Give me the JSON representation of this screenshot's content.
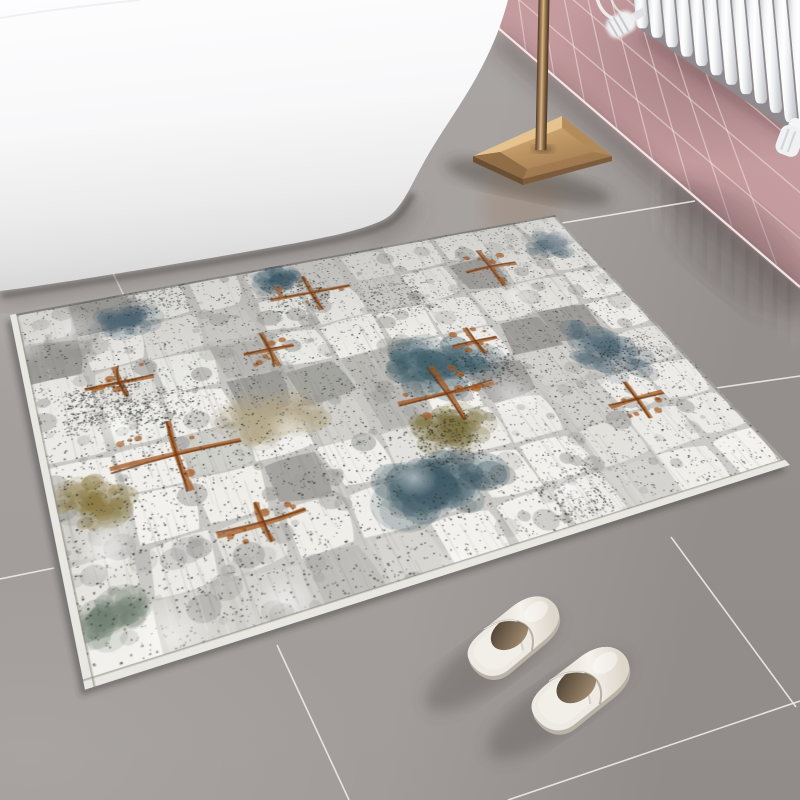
{
  "scene": {
    "title": "Bathroom scene: white freestanding bathtub, pink tiled wall, white column radiator, brass lamp base, abstract distressed grey-teal-rust rug and white slippers on glossy grey tile floor",
    "floor": {
      "base_color": "#a5a09e",
      "grout_color": "rgba(238,235,232,0.9)",
      "grout_segments": [
        [
          112,
          271,
          125,
          298
        ],
        [
          277,
          645,
          349,
          800
        ],
        [
          0,
          579,
          54,
          568
        ],
        [
          695,
          201,
          562,
          223
        ],
        [
          716,
          388,
          800,
          376
        ],
        [
          508,
          800,
          800,
          701
        ],
        [
          671,
          537,
          796,
          707
        ]
      ]
    },
    "wall": {
      "junction": [
        497,
        27,
        800,
        287
      ],
      "junction_color": "#f2eeec",
      "grout_color": "rgba(247,236,236,0.5)",
      "course_spacing": 46,
      "course_slope": 0.85,
      "joint_base_spacing": 26,
      "joint_spacing_growth": 0.08,
      "joint_lean_base": 0.12,
      "joint_lean_growth": 0.0009,
      "shadow_color": "rgba(75,55,55,0.32)"
    },
    "radiator": {
      "x0": 633,
      "bar_width": 12.3,
      "bar_pitch": 14.0,
      "count": 13,
      "lean": 0.09,
      "bottom_x": 637,
      "bottom_y": 26,
      "bottom_slope": 0.67,
      "backdrop_color": "#8e8a8e",
      "bar_stops": [
        "#c7c8cb",
        "#f5f6f7",
        "#ffffff",
        "#edeef0",
        "#bcbdc1"
      ],
      "valve_color": "#f0f1f3",
      "pipe_color": "#edeceb",
      "wall_shadow": "rgba(90,60,62,0.35)"
    },
    "bathtub": {
      "path": "M 0 0 L 508 0 C 501 26 493 47 476 78 C 458 110 440 133 423 164 C 409 189 401 211 383 220 C 358 232 318 239 268 248 C 178 264 78 280 30 287 C 17 289 7 290 0 291 Z",
      "shadow_path": "M 0 294 C 80 282 180 266 270 250 C 320 241 360 234 386 222 C 398 216 405 204 412 192",
      "gradient": [
        "#fdfdfe",
        "#f8f8f9",
        "#ececed",
        "#e2e1e2",
        "#d6d5d5"
      ],
      "contact_shadow": "rgba(58,54,51,0.6)",
      "soft_shadow": "rgba(90,85,82,0.35)",
      "seam_color": "rgba(0,0,0,0.05)"
    },
    "lamp": {
      "pole": {
        "x": 538.5,
        "top": -4,
        "bottom": 150,
        "w": 11,
        "stops": [
          "#4f3b28",
          "#a5825c",
          "#d9b586",
          "#8a6b48",
          "#46331f"
        ]
      },
      "base": {
        "L": [
          473,
          156
        ],
        "T": [
          562,
          116
        ],
        "R": [
          612,
          156
        ],
        "B": [
          523,
          179
        ],
        "inner": [
          [
            500,
            152
          ],
          [
            562,
            128
          ],
          [
            594,
            152
          ],
          [
            527,
            169
          ]
        ],
        "top_hi": "#e7c793",
        "top_mid": "#c39a68",
        "top_lo": "#9c7850",
        "bevel_left": "#8a6742",
        "bevel_right": "#b08a58",
        "side_dark": "#6b4f35",
        "side_mid": "#7d5c3d"
      },
      "shadow": "rgba(66,56,46,0.40)",
      "reflection": "rgba(150,115,75,0.22)"
    },
    "rug": {
      "quad": [
        [
          10,
          315
        ],
        [
          555,
          215
        ],
        [
          790,
          465
        ],
        [
          85,
          690
        ]
      ],
      "tex_w": 760,
      "tex_h": 520,
      "base": "#c8c7c3",
      "block_cols": 11,
      "block_rows": 8,
      "block_colors": [
        "#f2f1ed",
        "#e6e5e0",
        "#d2d1cc",
        "#b6b5b1",
        "#9c9b97"
      ],
      "speckle_dark": "#2c2c28",
      "speckle_mid": "#5a5a54",
      "features": [
        {
          "x": 0.6,
          "y": 0.47,
          "rx": 0.085,
          "ry": 0.085,
          "c": "#43616d"
        },
        {
          "x": 0.5,
          "y": 0.8,
          "rx": 0.09,
          "ry": 0.065,
          "c": "#3e5a66"
        },
        {
          "x": 0.17,
          "y": 0.1,
          "rx": 0.05,
          "ry": 0.05,
          "c": "#4a6676"
        },
        {
          "x": 0.88,
          "y": 0.54,
          "rx": 0.06,
          "ry": 0.1,
          "c": "#546c7a"
        },
        {
          "x": 0.43,
          "y": 0.05,
          "rx": 0.045,
          "ry": 0.04,
          "c": "#36586a"
        },
        {
          "x": 0.93,
          "y": 0.12,
          "rx": 0.05,
          "ry": 0.05,
          "c": "#5f7480"
        },
        {
          "x": 0.055,
          "y": 0.62,
          "rx": 0.05,
          "ry": 0.06,
          "c": "#8d7c48"
        },
        {
          "x": 0.56,
          "y": 0.66,
          "rx": 0.06,
          "ry": 0.05,
          "c": "#7e7444"
        },
        {
          "x": 0.33,
          "y": 0.52,
          "rx": 0.07,
          "ry": 0.06,
          "c": "#b3a78a"
        },
        {
          "x": 0.04,
          "y": 0.88,
          "rx": 0.045,
          "ry": 0.04,
          "c": "#6a7a6a"
        }
      ],
      "rust_color": "#a4571f",
      "rust_dark": "#6e3a14",
      "rust_crosses": [
        [
          0.175,
          0.55,
          0.09,
          0.1
        ],
        [
          0.47,
          0.13,
          0.07,
          0.07
        ],
        [
          0.585,
          0.56,
          0.08,
          0.09
        ],
        [
          0.8,
          0.17,
          0.05,
          0.08
        ],
        [
          0.13,
          0.3,
          0.05,
          0.05
        ],
        [
          0.25,
          0.77,
          0.06,
          0.05
        ],
        [
          0.68,
          0.42,
          0.04,
          0.05
        ],
        [
          0.86,
          0.72,
          0.05,
          0.06
        ],
        [
          0.36,
          0.3,
          0.04,
          0.06
        ]
      ],
      "binding": "#e9e7e1",
      "edge_shadow": "rgba(60,58,56,0.45)",
      "floor_shadow": "rgba(50,46,44,0.40)"
    },
    "slippers": {
      "colors": {
        "shell": "#eceae3",
        "insole": "#f2efe8",
        "insole_edge": "#d8d1c5",
        "vamp_hi": "#f6f3ed",
        "vamp_lo": "#ddd6ca",
        "opening_dark": "#473a2d",
        "opening_lit": "#a08b70",
        "sole": "#b9b2a6"
      },
      "shadow_color": "rgba(95,90,86,0.42)",
      "items": [
        {
          "x": 450,
          "y": 648,
          "rot": -36,
          "scale": 0.66
        },
        {
          "x": 513,
          "y": 700,
          "rot": -35,
          "scale": 0.7
        }
      ],
      "shadows": [
        [
          492,
          660,
          80,
          26,
          -36
        ],
        [
          558,
          706,
          84,
          27,
          -35
        ]
      ]
    }
  }
}
